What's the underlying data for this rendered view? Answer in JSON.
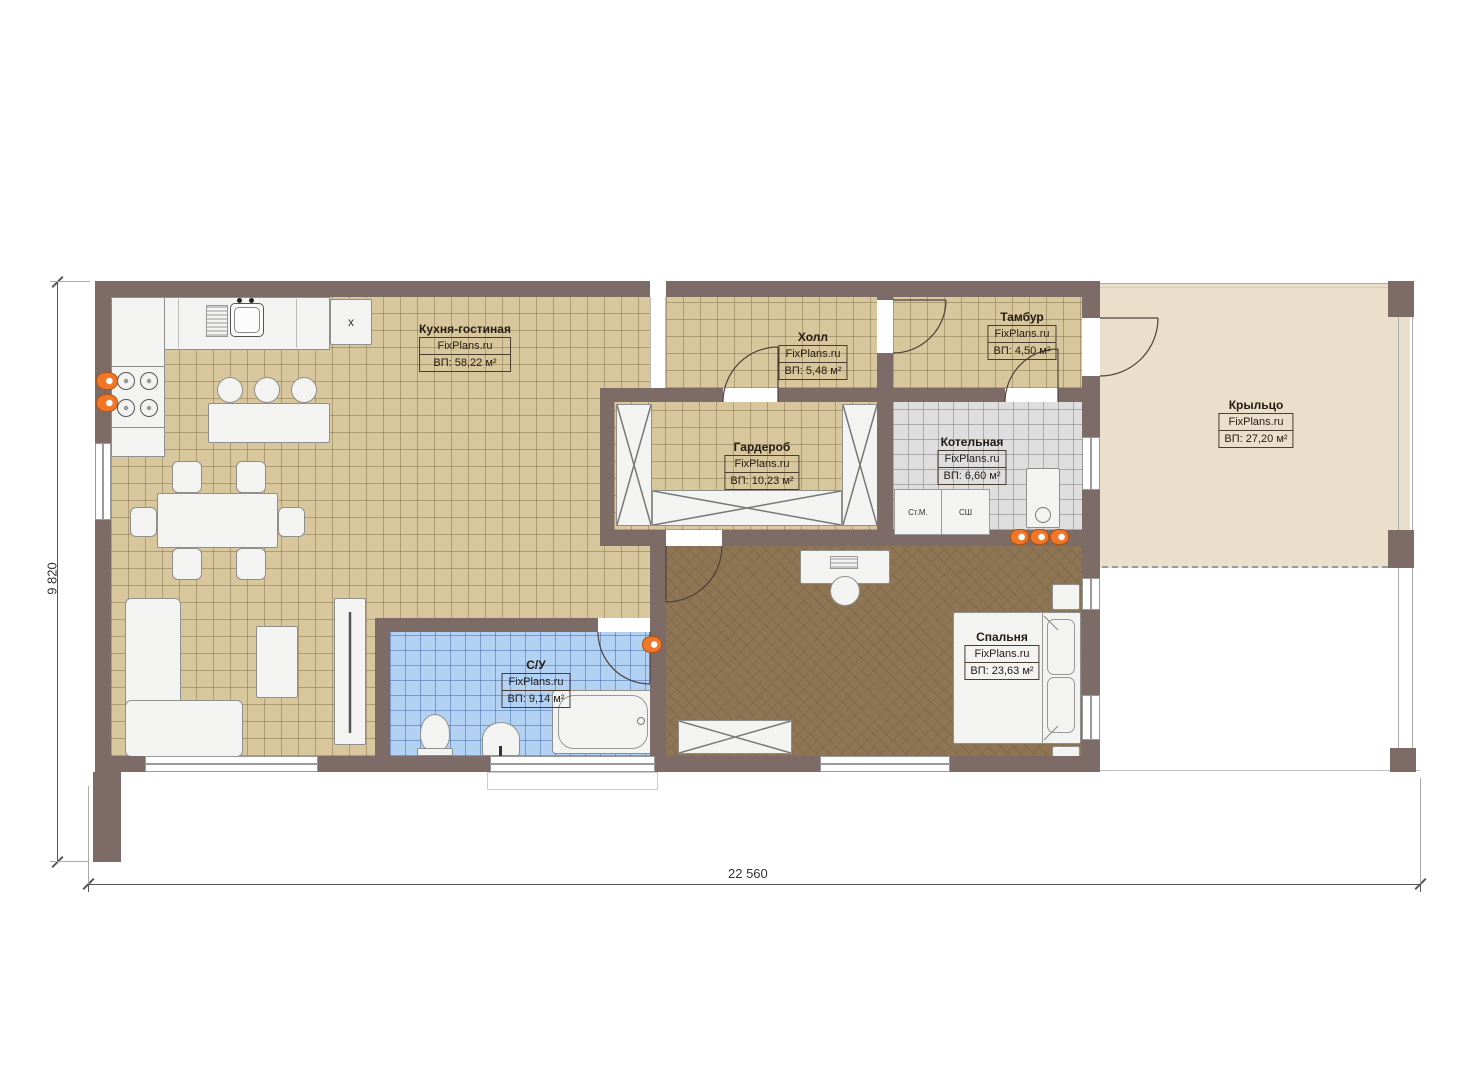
{
  "plan": {
    "dimensions": {
      "width": "22 560",
      "height": "9 820"
    }
  },
  "rooms": [
    {
      "name": "Кухня-гостиная",
      "brand": "FixPlans.ru",
      "area": "ВП: 58,22 м²"
    },
    {
      "name": "Холл",
      "brand": "FixPlans.ru",
      "area": "ВП: 5,48 м²"
    },
    {
      "name": "Тамбур",
      "brand": "FixPlans.ru",
      "area": "ВП: 4,50 м²"
    },
    {
      "name": "Гардероб",
      "brand": "FixPlans.ru",
      "area": "ВП: 10,23 м²"
    },
    {
      "name": "Котельная",
      "brand": "FixPlans.ru",
      "area": "ВП: 6,60 м²"
    },
    {
      "name": "Крыльцо",
      "brand": "FixPlans.ru",
      "area": "ВП: 27,20 м²"
    },
    {
      "name": "С/У",
      "brand": "FixPlans.ru",
      "area": "ВП: 9,14 м²"
    },
    {
      "name": "Спальня",
      "brand": "FixPlans.ru",
      "area": "ВП: 23,63 м²"
    }
  ],
  "appliances": {
    "washer": "Ст.М.",
    "dryer": "СШ",
    "fridge": "x"
  },
  "colors": {
    "wall": "#7d6b68",
    "tile": "#d8c79c",
    "bathroom": "#b2d1f3",
    "boiler_room": "#dedede",
    "bedroom_floor": "#8e7554",
    "porch": "#e9dfcb",
    "accent_orange": "#f0772a"
  }
}
